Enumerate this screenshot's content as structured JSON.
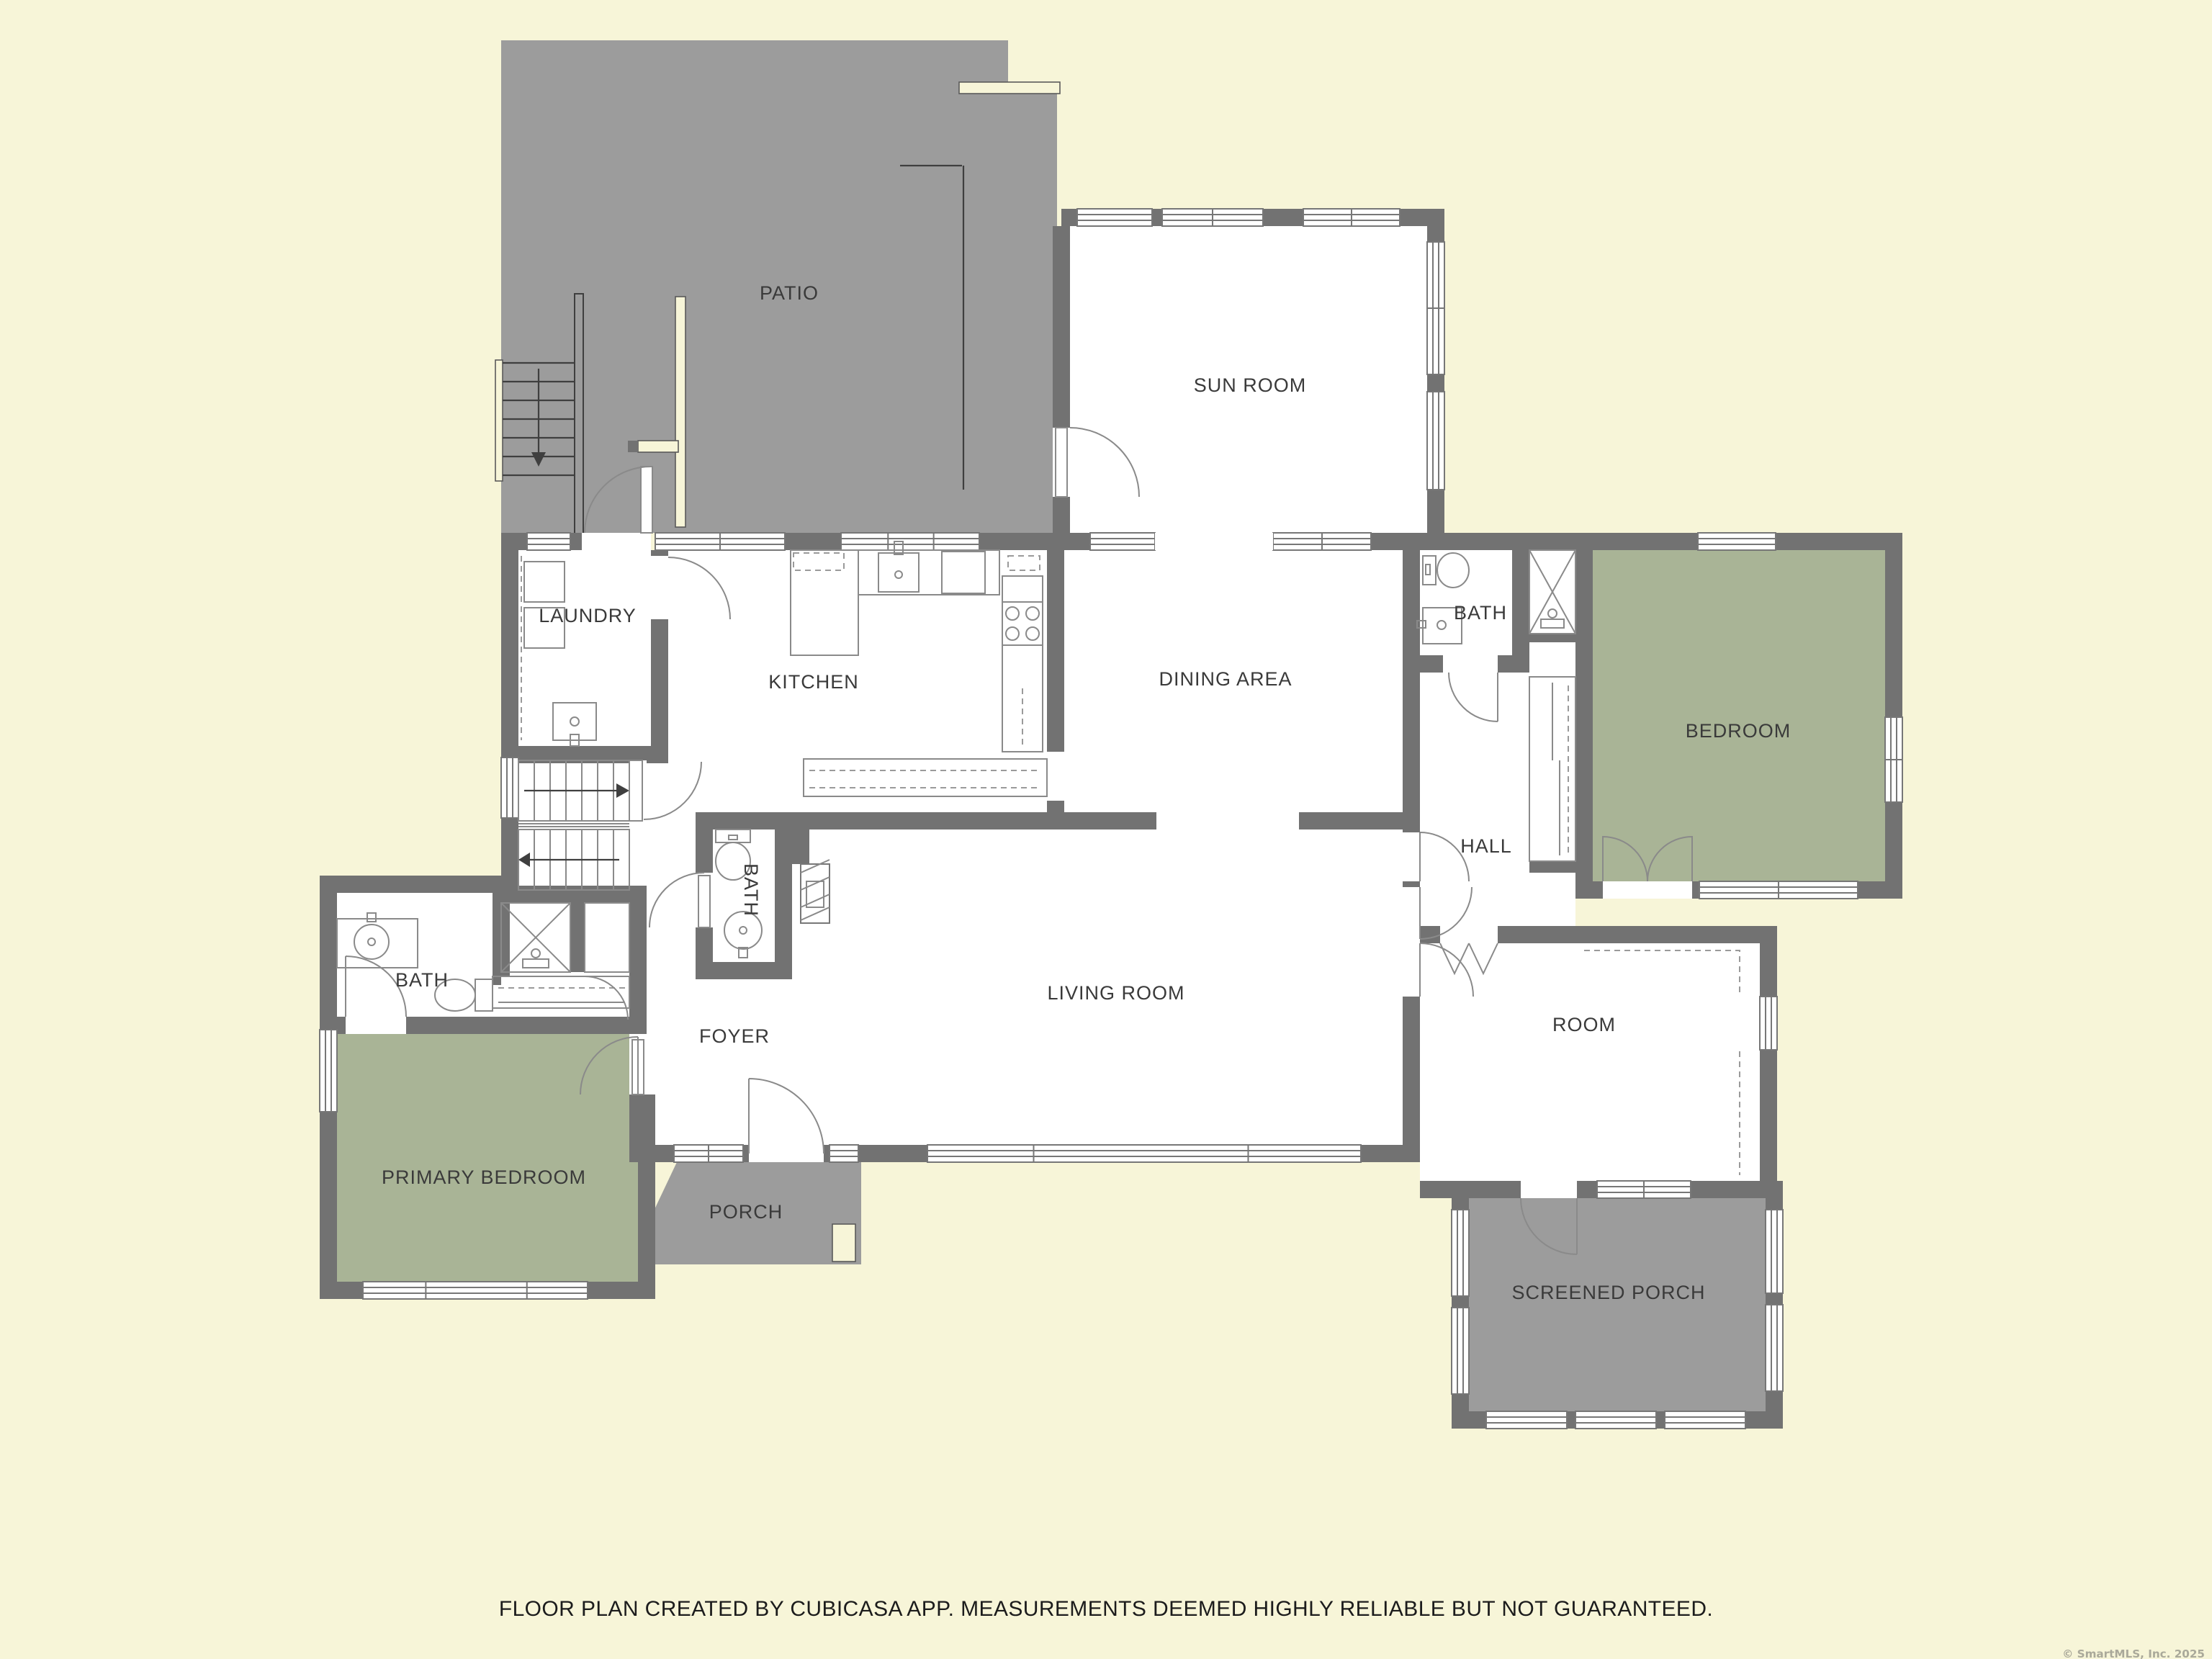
{
  "meta": {
    "footer": "FLOOR PLAN CREATED BY CUBICASA APP. MEASUREMENTS DEEMED HIGHLY RELIABLE BUT NOT GUARANTEED.",
    "copyright": "© SmartMLS, Inc.  2025"
  },
  "colors": {
    "background": "#F7F5D8",
    "wall": "#727272",
    "outdoor_area": "#9C9C9C",
    "room": "#FFFFFF",
    "bedroom": "#A9B496",
    "label_text": "#3A3A3A"
  },
  "rooms": [
    {
      "id": "patio",
      "label": "PATIO",
      "type": "outdoor"
    },
    {
      "id": "sun-room",
      "label": "SUN ROOM",
      "type": "room"
    },
    {
      "id": "laundry",
      "label": "LAUNDRY",
      "type": "room"
    },
    {
      "id": "kitchen",
      "label": "KITCHEN",
      "type": "room"
    },
    {
      "id": "dining-area",
      "label": "DINING AREA",
      "type": "room"
    },
    {
      "id": "bath-upper",
      "label": "BATH",
      "type": "room"
    },
    {
      "id": "bedroom",
      "label": "BEDROOM",
      "type": "bedroom"
    },
    {
      "id": "hall",
      "label": "HALL",
      "type": "room"
    },
    {
      "id": "bath-foyer",
      "label": "BATH",
      "type": "room",
      "orientation": "vertical"
    },
    {
      "id": "living-room",
      "label": "LIVING ROOM",
      "type": "room"
    },
    {
      "id": "foyer",
      "label": "FOYER",
      "type": "room"
    },
    {
      "id": "bath-left",
      "label": "BATH",
      "type": "room"
    },
    {
      "id": "primary-bedroom",
      "label": "PRIMARY BEDROOM",
      "type": "bedroom"
    },
    {
      "id": "porch",
      "label": "PORCH",
      "type": "outdoor"
    },
    {
      "id": "room",
      "label": "ROOM",
      "type": "room"
    },
    {
      "id": "screened-porch",
      "label": "SCREENED PORCH",
      "type": "outdoor"
    }
  ]
}
